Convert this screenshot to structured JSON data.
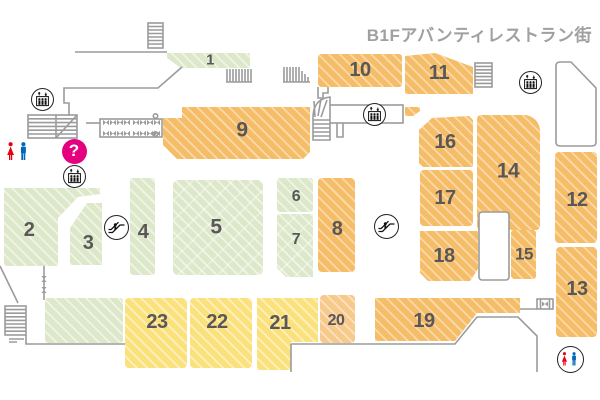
{
  "title": "B1Fアバンティレストラン街",
  "info": {
    "glyph": "?"
  },
  "colors": {
    "orange": "#f6bd69",
    "light_orange": "#f7c98b",
    "green": "#dce8c9",
    "yellow": "#fbe17c",
    "wall_gray": "#9b9b9b",
    "label_gray": "#595757",
    "title_gray": "#a0a0a1",
    "info_magenta": "#e4007f",
    "restroom_red": "#e60012",
    "restroom_blue": "#0068b7"
  },
  "map": {
    "blocks": [
      {
        "num": "1",
        "color": "green",
        "x": 165,
        "y": 52,
        "w": 85,
        "h": 17,
        "clip": "2 1,85 1,85 16,16 16,2 6",
        "lx": 210,
        "ly": 60,
        "fs": 15
      },
      {
        "num": "2",
        "color": "green",
        "x": 4,
        "y": 188,
        "w": 96,
        "h": 78,
        "clip": "0 0,96 0,96 6,74 9,54 30,54 78,0 78",
        "lx": 29,
        "ly": 230,
        "fs": 20
      },
      {
        "num": "3",
        "color": "green",
        "x": 70,
        "y": 203,
        "w": 32,
        "h": 62,
        "clip": "17 0,32 0,32 62,0 62,0 25",
        "lx": 88,
        "ly": 243,
        "fs": 20
      },
      {
        "num": "4",
        "color": "green",
        "x": 130,
        "y": 178,
        "w": 25,
        "h": 97,
        "r": "3px",
        "lx": 143,
        "ly": 232,
        "fs": 20
      },
      {
        "num": "5",
        "color": "green-x",
        "x": 173,
        "y": 180,
        "w": 90,
        "h": 95,
        "r": "5px",
        "lx": 216,
        "ly": 227,
        "fs": 21
      },
      {
        "num": "6",
        "color": "green",
        "x": 277,
        "y": 178,
        "w": 36,
        "h": 34,
        "r": "3px",
        "lx": 296,
        "ly": 197,
        "fs": 16
      },
      {
        "num": "7",
        "color": "green-x",
        "x": 277,
        "y": 214,
        "w": 36,
        "h": 63,
        "clip": "0 0,36 0,36 63,9 63,0 54",
        "lx": 296,
        "ly": 240,
        "fs": 16
      },
      {
        "num": "8",
        "color": "orange",
        "x": 318,
        "y": 178,
        "w": 37,
        "h": 94,
        "r": "4px",
        "lx": 337,
        "ly": 229,
        "fs": 20
      },
      {
        "num": "9",
        "color": "orange",
        "x": 163,
        "y": 107,
        "w": 147,
        "h": 52,
        "clip": "19 0,147 0,147 45,140 52,14 52,0 38,0 11,19 11",
        "lx": 242,
        "ly": 130,
        "fs": 21
      },
      {
        "num": "10",
        "color": "orange",
        "x": 318,
        "y": 54,
        "w": 84,
        "h": 33,
        "r": "3px",
        "lx": 360,
        "ly": 70,
        "fs": 20
      },
      {
        "num": "11",
        "color": "orange",
        "x": 405,
        "y": 53,
        "w": 68,
        "h": 41,
        "clip": "0 3,30 0,68 14,68 41,0 41",
        "lx": 439,
        "ly": 73,
        "fs": 20
      },
      {
        "num": "12",
        "color": "orange",
        "x": 555,
        "y": 152,
        "w": 42,
        "h": 91,
        "r": "4px",
        "lx": 577,
        "ly": 200,
        "fs": 20
      },
      {
        "num": "13",
        "color": "orange",
        "x": 556,
        "y": 247,
        "w": 41,
        "h": 90,
        "r": "4px",
        "lx": 577,
        "ly": 289,
        "fs": 20
      },
      {
        "num": "14",
        "color": "orange",
        "x": 477,
        "y": 115,
        "w": 63,
        "h": 115,
        "r": "4px 16px 4px 4px",
        "lx": 508,
        "ly": 171,
        "fs": 21
      },
      {
        "num": "15",
        "color": "orange",
        "x": 511,
        "y": 230,
        "w": 25,
        "h": 49,
        "r": "3px",
        "lx": 524,
        "ly": 254,
        "fs": 17
      },
      {
        "num": "16",
        "color": "orange",
        "x": 419,
        "y": 116,
        "w": 54,
        "h": 51,
        "clip": "13 2,50 0,54 4,54 51,4 51,0 47,0 14",
        "lx": 445,
        "ly": 142,
        "fs": 20
      },
      {
        "num": "17",
        "color": "orange",
        "x": 420,
        "y": 170,
        "w": 53,
        "h": 56,
        "r": "4px",
        "lx": 445,
        "ly": 198,
        "fs": 20
      },
      {
        "num": "18",
        "color": "orange",
        "x": 420,
        "y": 231,
        "w": 58,
        "h": 50,
        "clip": "0 0,58 0,58 38,50 50,8 50,0 42",
        "lx": 444,
        "ly": 256,
        "fs": 20
      },
      {
        "num": "19",
        "color": "orange",
        "x": 375,
        "y": 298,
        "w": 145,
        "h": 43,
        "clip": "0 0,145 0,145 15,102 15,80 43,0 43",
        "lx": 424,
        "ly": 321,
        "fs": 20
      },
      {
        "num": "20",
        "color": "lorange",
        "x": 320,
        "y": 295,
        "w": 35,
        "h": 48,
        "r": "4px",
        "lx": 336,
        "ly": 321,
        "fs": 16
      },
      {
        "num": "21",
        "color": "yellow",
        "x": 257,
        "y": 298,
        "w": 61,
        "h": 72,
        "clip": "0 0,61 0,61 44,34 44,34 72,0 72",
        "lx": 280,
        "ly": 323,
        "fs": 20
      },
      {
        "num": "22",
        "color": "yellow",
        "x": 190,
        "y": 298,
        "w": 62,
        "h": 70,
        "r": "4px",
        "lx": 217,
        "ly": 322,
        "fs": 20
      },
      {
        "num": "23",
        "color": "yellow",
        "x": 125,
        "y": 298,
        "w": 62,
        "h": 70,
        "r": "4px",
        "lx": 157,
        "ly": 322,
        "fs": 20
      }
    ],
    "unlabeled_blocks": [
      {
        "name": "green-block-unlabeled",
        "color": "green",
        "x": 45,
        "y": 298,
        "w": 78,
        "h": 45,
        "r": "3px"
      },
      {
        "name": "orange-fragment",
        "color": "orange",
        "x": 405,
        "y": 107,
        "w": 15,
        "h": 9,
        "clip": "0 0,15 0,15 4,8 9,0 9"
      }
    ],
    "icons": [
      {
        "name": "elevator-icon",
        "x": 42,
        "y": 99
      },
      {
        "name": "elevator-icon",
        "x": 74,
        "y": 176
      },
      {
        "name": "elevator-icon",
        "x": 374,
        "y": 114
      },
      {
        "name": "elevator-icon",
        "x": 530,
        "y": 82
      },
      {
        "name": "escalator-icon",
        "x": 116,
        "y": 227
      },
      {
        "name": "escalator-icon",
        "x": 386,
        "y": 226
      },
      {
        "name": "information-icon",
        "x": 74,
        "y": 151
      },
      {
        "name": "restroom-icon",
        "x": 17,
        "y": 153
      },
      {
        "name": "restroom-circle-icon",
        "x": 570,
        "y": 359
      }
    ]
  }
}
